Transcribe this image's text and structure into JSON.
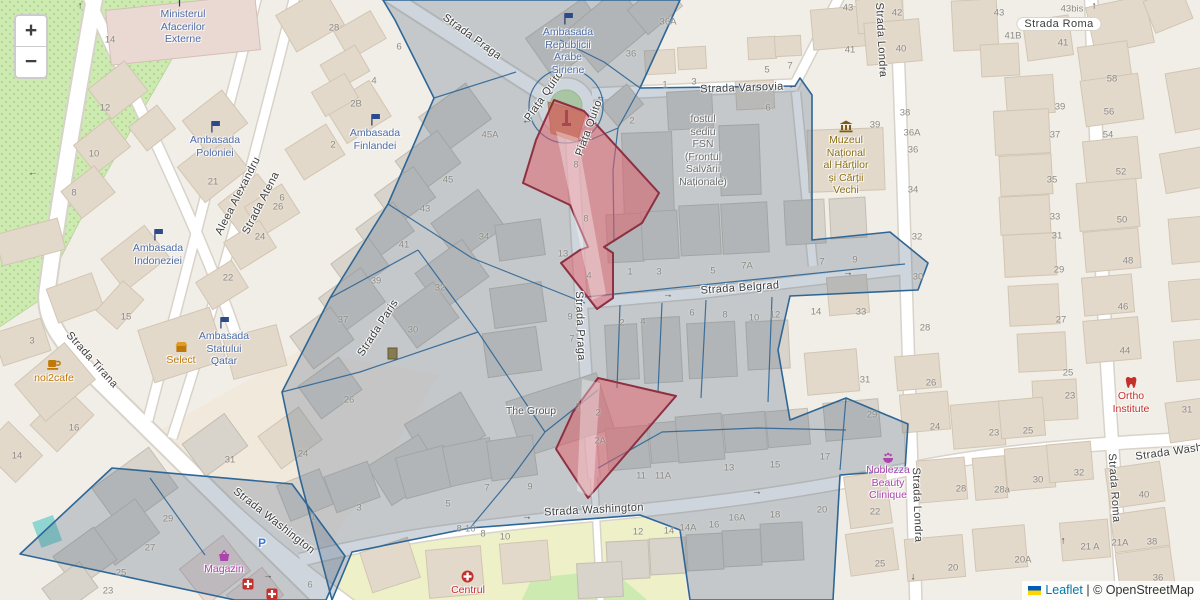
{
  "map": {
    "controls": {
      "zoom_in": "+",
      "zoom_out": "−"
    },
    "attribution": {
      "leaflet": "Leaflet",
      "separator": " | ",
      "osm": "© OpenStreetMap"
    },
    "colors": {
      "overlay_stroke": "#2e6696",
      "highlight_stroke": "#8e2f42",
      "highlight_fill": "#ec9aa2",
      "park": "#cdebb0",
      "road": "#ffffff",
      "poi_blue": "#4d6ba5",
      "poi_orange": "#c07807",
      "poi_brown": "#8a6d14",
      "poi_purple": "#ad44ad",
      "poi_red": "#c4302b"
    },
    "street_labels": [
      {
        "t": "Strada Praga",
        "x": 472,
        "y": 37,
        "r": 36
      },
      {
        "t": "Piața Quito",
        "x": 544,
        "y": 96,
        "r": -55
      },
      {
        "t": "Piața Quito",
        "x": 589,
        "y": 128,
        "r": -70
      },
      {
        "t": "Strada Varsovia",
        "x": 742,
        "y": 88,
        "r": -2
      },
      {
        "t": "Strada Roma",
        "x": 1059,
        "y": 24,
        "r": 0,
        "p": 1
      },
      {
        "t": "Strada Londra",
        "x": 881,
        "y": 40,
        "r": 87
      },
      {
        "t": "Strada Belgrad",
        "x": 740,
        "y": 288,
        "r": -4
      },
      {
        "t": "Strada Paris",
        "x": 378,
        "y": 328,
        "r": -57
      },
      {
        "t": "Strada Praga",
        "x": 580,
        "y": 326,
        "r": 88
      },
      {
        "t": "Aleea Alexandru",
        "x": 238,
        "y": 196,
        "r": -63
      },
      {
        "t": "Strada Atena",
        "x": 261,
        "y": 203,
        "r": -63
      },
      {
        "t": "Strada Tirana",
        "x": 92,
        "y": 360,
        "r": 48
      },
      {
        "t": "Strada Washington",
        "x": 274,
        "y": 521,
        "r": 38
      },
      {
        "t": "Strada Washington",
        "x": 594,
        "y": 510,
        "r": -3
      },
      {
        "t": "Strada Washington",
        "x": 1185,
        "y": 450,
        "r": -8
      },
      {
        "t": "Strada Londra",
        "x": 917,
        "y": 505,
        "r": 88
      },
      {
        "t": "Strada Roma",
        "x": 1114,
        "y": 488,
        "r": 86
      }
    ],
    "house_numbers": [
      [
        110,
        40,
        "14"
      ],
      [
        105,
        108,
        "12"
      ],
      [
        94,
        154,
        "10"
      ],
      [
        74,
        193,
        "8"
      ],
      [
        213,
        182,
        "21"
      ],
      [
        32,
        341,
        "3"
      ],
      [
        126,
        317,
        "15"
      ],
      [
        74,
        428,
        "16"
      ],
      [
        17,
        456,
        "14"
      ],
      [
        333,
        145,
        "2"
      ],
      [
        278,
        207,
        "26"
      ],
      [
        260,
        237,
        "24"
      ],
      [
        228,
        278,
        "22"
      ],
      [
        334,
        28,
        "28"
      ],
      [
        399,
        47,
        "6"
      ],
      [
        374,
        81,
        "4"
      ],
      [
        356,
        104,
        "2B"
      ],
      [
        282,
        198,
        "6"
      ],
      [
        490,
        135,
        "45A"
      ],
      [
        448,
        180,
        "45"
      ],
      [
        425,
        209,
        "43"
      ],
      [
        404,
        245,
        "41"
      ],
      [
        376,
        281,
        "39"
      ],
      [
        484,
        237,
        "34"
      ],
      [
        343,
        320,
        "37"
      ],
      [
        440,
        288,
        "32"
      ],
      [
        413,
        330,
        "30"
      ],
      [
        349,
        400,
        "26"
      ],
      [
        563,
        254,
        "13"
      ],
      [
        570,
        317,
        "9"
      ],
      [
        572,
        339,
        "7"
      ],
      [
        487,
        488,
        "7"
      ],
      [
        530,
        487,
        "9"
      ],
      [
        578,
        407,
        "3"
      ],
      [
        576,
        165,
        "8"
      ],
      [
        586,
        219,
        "8"
      ],
      [
        589,
        276,
        "4"
      ],
      [
        598,
        413,
        "2"
      ],
      [
        600,
        441,
        "2A"
      ],
      [
        668,
        22,
        "36A"
      ],
      [
        631,
        54,
        "36"
      ],
      [
        665,
        85,
        "1"
      ],
      [
        694,
        82,
        "3"
      ],
      [
        767,
        70,
        "5"
      ],
      [
        790,
        66,
        "7"
      ],
      [
        768,
        108,
        "6"
      ],
      [
        632,
        121,
        "2"
      ],
      [
        630,
        272,
        "1"
      ],
      [
        659,
        272,
        "3"
      ],
      [
        713,
        271,
        "5"
      ],
      [
        747,
        266,
        "7A"
      ],
      [
        822,
        262,
        "7"
      ],
      [
        855,
        260,
        "9"
      ],
      [
        622,
        323,
        "2"
      ],
      [
        643,
        322,
        "4"
      ],
      [
        692,
        313,
        "6"
      ],
      [
        725,
        315,
        "8"
      ],
      [
        754,
        318,
        "10"
      ],
      [
        775,
        315,
        "12"
      ],
      [
        816,
        312,
        "14"
      ],
      [
        861,
        312,
        "33"
      ],
      [
        865,
        380,
        "31"
      ],
      [
        872,
        415,
        "29"
      ],
      [
        875,
        125,
        "39"
      ],
      [
        905,
        113,
        "38"
      ],
      [
        912,
        133,
        "36A"
      ],
      [
        913,
        150,
        "36"
      ],
      [
        913,
        190,
        "34"
      ],
      [
        917,
        237,
        "32"
      ],
      [
        918,
        277,
        "30"
      ],
      [
        925,
        328,
        "28"
      ],
      [
        931,
        383,
        "26"
      ],
      [
        935,
        427,
        "24"
      ],
      [
        848,
        8,
        "43"
      ],
      [
        897,
        13,
        "42"
      ],
      [
        901,
        49,
        "40"
      ],
      [
        850,
        50,
        "41"
      ],
      [
        999,
        13,
        "43"
      ],
      [
        1072,
        9,
        "43bis"
      ],
      [
        1013,
        36,
        "41B"
      ],
      [
        1063,
        43,
        "41"
      ],
      [
        1060,
        107,
        "39"
      ],
      [
        1112,
        79,
        "58"
      ],
      [
        1109,
        112,
        "56"
      ],
      [
        1108,
        135,
        "54"
      ],
      [
        1121,
        172,
        "52"
      ],
      [
        1122,
        220,
        "50"
      ],
      [
        1128,
        261,
        "48"
      ],
      [
        1123,
        307,
        "46"
      ],
      [
        1125,
        351,
        "44"
      ],
      [
        1055,
        135,
        "37"
      ],
      [
        1052,
        180,
        "35"
      ],
      [
        1055,
        217,
        "33"
      ],
      [
        1057,
        236,
        "31"
      ],
      [
        1059,
        270,
        "29"
      ],
      [
        1061,
        320,
        "27"
      ],
      [
        1068,
        373,
        "25"
      ],
      [
        1070,
        396,
        "23"
      ],
      [
        1187,
        410,
        "31"
      ],
      [
        1144,
        495,
        "40"
      ],
      [
        1152,
        542,
        "38"
      ],
      [
        1158,
        578,
        "36"
      ],
      [
        1090,
        547,
        "21 A"
      ],
      [
        1120,
        543,
        "21A"
      ],
      [
        994,
        433,
        "23"
      ],
      [
        1028,
        431,
        "25"
      ],
      [
        961,
        489,
        "28"
      ],
      [
        1002,
        490,
        "28a"
      ],
      [
        1038,
        480,
        "30"
      ],
      [
        1079,
        473,
        "32"
      ],
      [
        875,
        512,
        "22"
      ],
      [
        880,
        564,
        "25"
      ],
      [
        953,
        568,
        "20"
      ],
      [
        1023,
        560,
        "20A"
      ],
      [
        641,
        476,
        "11"
      ],
      [
        663,
        476,
        "11A"
      ],
      [
        729,
        468,
        "13"
      ],
      [
        775,
        465,
        "15"
      ],
      [
        825,
        457,
        "17"
      ],
      [
        638,
        532,
        "12"
      ],
      [
        669,
        531,
        "14"
      ],
      [
        688,
        528,
        "14A"
      ],
      [
        714,
        525,
        "16"
      ],
      [
        737,
        518,
        "16A"
      ],
      [
        775,
        515,
        "18"
      ],
      [
        822,
        510,
        "20"
      ],
      [
        230,
        460,
        "31"
      ],
      [
        303,
        454,
        "24"
      ],
      [
        168,
        519,
        "29"
      ],
      [
        150,
        548,
        "27"
      ],
      [
        121,
        573,
        "25"
      ],
      [
        108,
        591,
        "23"
      ],
      [
        313,
        517,
        "1"
      ],
      [
        359,
        508,
        "3"
      ],
      [
        448,
        504,
        "5"
      ],
      [
        310,
        585,
        "6"
      ],
      [
        505,
        537,
        "10"
      ],
      [
        483,
        534,
        "8"
      ],
      [
        466,
        529,
        "8-10"
      ]
    ],
    "arrows": [
      [
        80,
        6,
        "↑"
      ],
      [
        33,
        173,
        "←"
      ],
      [
        793,
        86,
        "←"
      ],
      [
        883,
        71,
        "↓"
      ],
      [
        1094,
        6,
        "↑"
      ],
      [
        668,
        295,
        "→"
      ],
      [
        848,
        273,
        "→"
      ],
      [
        527,
        517,
        "→"
      ],
      [
        757,
        492,
        "→"
      ],
      [
        913,
        577,
        "↓"
      ],
      [
        1063,
        541,
        "↑"
      ],
      [
        268,
        576,
        "→"
      ],
      [
        527,
        121,
        "←"
      ],
      [
        601,
        97,
        "←"
      ]
    ],
    "pois": [
      {
        "x": 183,
        "y": -6,
        "icon": "flag",
        "color": "blue",
        "lines": [
          "Ministerul",
          "Afacerilor",
          "Externe"
        ],
        "name": "ministerul-afacerilor-externe"
      },
      {
        "x": 568,
        "y": 12,
        "icon": "flag",
        "color": "blue",
        "lines": [
          "Ambasada",
          "Republicii",
          "Arabe",
          "Siriene"
        ],
        "name": "ambasada-republicii-arabe-siriene"
      },
      {
        "x": 215,
        "y": 120,
        "icon": "flag",
        "color": "blue",
        "lines": [
          "Ambasada",
          "Poloniei"
        ],
        "name": "ambasada-poloniei"
      },
      {
        "x": 375,
        "y": 113,
        "icon": "flag",
        "color": "blue",
        "lines": [
          "Ambasada",
          "Finlandei"
        ],
        "name": "ambasada-finlandei"
      },
      {
        "x": 158,
        "y": 228,
        "icon": "flag",
        "color": "blue",
        "lines": [
          "Ambasada",
          "Indoneziei"
        ],
        "name": "ambasada-indoneziei"
      },
      {
        "x": 224,
        "y": 316,
        "icon": "flag",
        "color": "blue",
        "lines": [
          "Ambasada",
          "Statului",
          "Qatar"
        ],
        "name": "ambasada-statului-qatar"
      },
      {
        "x": 54,
        "y": 358,
        "icon": "cup",
        "color": "orange",
        "lines": [
          "noi2cafe"
        ],
        "name": "noi2cafe"
      },
      {
        "x": 181,
        "y": 341,
        "icon": "shop",
        "color": "orange",
        "lines": [
          "Select"
        ],
        "name": "select"
      },
      {
        "x": 846,
        "y": 120,
        "icon": "museum",
        "color": "brown",
        "lines": [
          "Muzeul",
          "Național",
          "al Hărților",
          "și Cărții",
          "Vechi"
        ],
        "name": "muzeul-national-al-hartilor"
      },
      {
        "x": 703,
        "y": 113,
        "icon": "",
        "color": "gray",
        "lines": [
          "fostul",
          "sediu",
          "FSN",
          "(Frontul",
          "Salvării",
          "Naționale)"
        ],
        "name": "fostul-sediu-fsn"
      },
      {
        "x": 531,
        "y": 405,
        "icon": "",
        "color": "darkgray",
        "lines": [
          "The Group"
        ],
        "name": "the-group"
      },
      {
        "x": 888,
        "y": 452,
        "icon": "spa",
        "color": "purple",
        "lines": [
          "Noblezza",
          "Beauty",
          "Clinique"
        ],
        "name": "noblezza-beauty-clinique"
      },
      {
        "x": 1131,
        "y": 376,
        "icon": "tooth",
        "color": "red",
        "lines": [
          "Ortho",
          "Institute"
        ],
        "name": "ortho-institute"
      },
      {
        "x": 224,
        "y": 550,
        "icon": "basket",
        "color": "purple",
        "lines": [
          "Magazin"
        ],
        "name": "magazin"
      },
      {
        "x": 468,
        "y": 570,
        "icon": "hospital",
        "color": "red",
        "lines": [
          "Centrul"
        ],
        "name": "centrul"
      },
      {
        "x": 262,
        "y": 536,
        "icon": "parking",
        "color": "blue",
        "lines": [],
        "name": "parking"
      },
      {
        "x": 248,
        "y": 578,
        "icon": "pharmacy",
        "color": "red",
        "lines": [],
        "name": "pharmacy-1"
      },
      {
        "x": 272,
        "y": 588,
        "icon": "pharmacy",
        "color": "red",
        "lines": [],
        "name": "pharmacy-2"
      }
    ]
  }
}
